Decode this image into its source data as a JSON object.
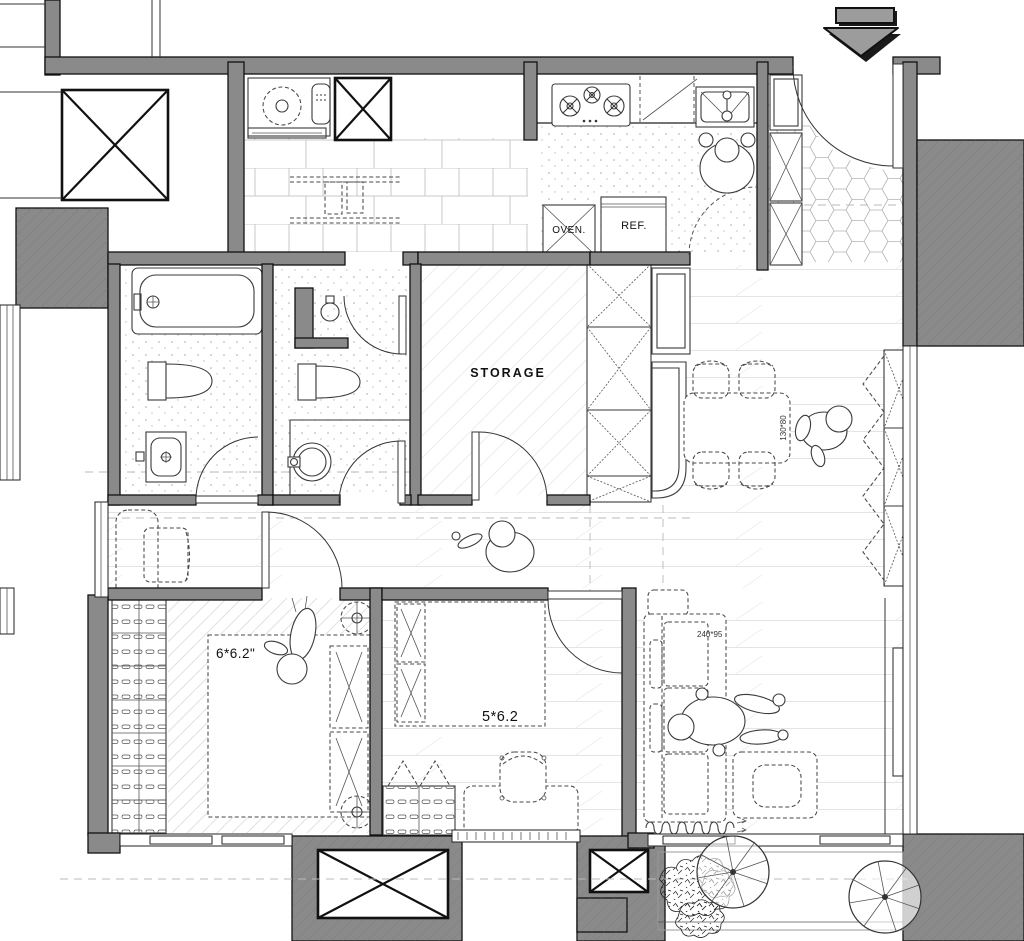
{
  "labels": {
    "storage": "STORAGE",
    "oven": "OVEN.",
    "fridge": "REF.",
    "master_bedroom_bed_size": "6*6.2\"",
    "second_bedroom_bed_size": "5*6.2",
    "dining_table_size": "130*80",
    "sofa_size": "240*95"
  },
  "colors": {
    "wall_fill": "#8a8a8a",
    "wall_outline": "#111111",
    "entry_arrow_fill": "#9c9c9c",
    "furniture_line": "#3a3a3a",
    "floor_line": "#e2e2e2"
  },
  "icons": {
    "entry": "down-arrow"
  }
}
